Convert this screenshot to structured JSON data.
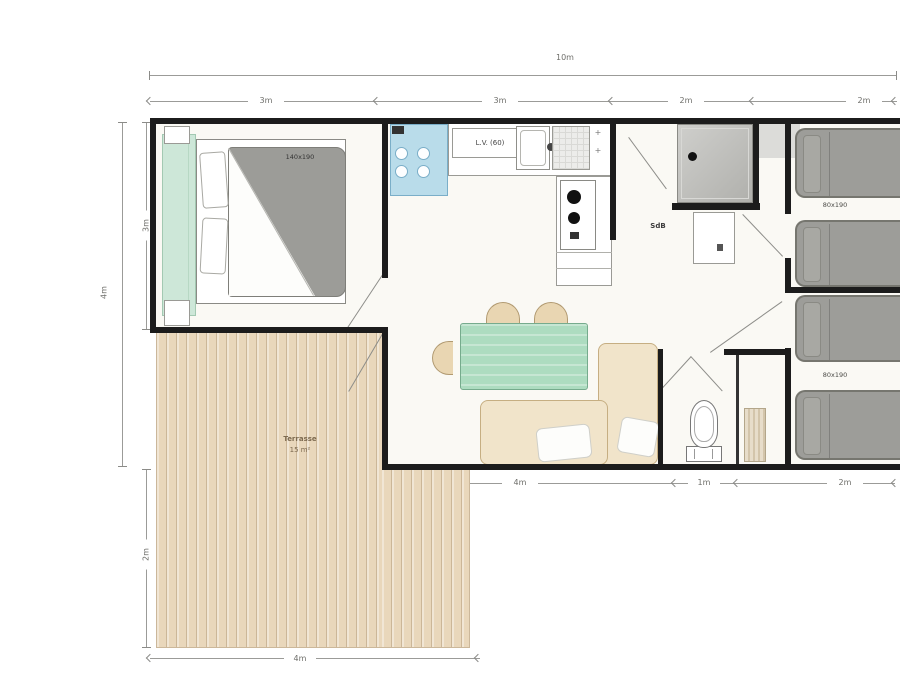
{
  "dimensions": {
    "top_total": "10m",
    "top_segments": [
      "3m",
      "3m",
      "2m",
      "2m"
    ],
    "left_outer": "4m",
    "left_inner": "3m",
    "left_terrace": "2m",
    "bottom_segments": [
      "4m",
      "1m",
      "2m"
    ],
    "bottom_terrace": "4m"
  },
  "labels": {
    "master_bed_size": "140x190",
    "kitchen_unit": "L.V. (60)",
    "bathroom": "SdB",
    "twin_beds_top": "80x190",
    "twin_beds_bottom": "80x190",
    "terrace_name": "Terrasse",
    "terrace_area": "15 m²",
    "plus_mark_1": "+",
    "plus_mark_2": "+"
  },
  "colors": {
    "wall": "#1c1c1c",
    "terrace_wood": "#e9d7bb",
    "wardrobe_mint": "#cde7d8",
    "table_green": "#addcc0",
    "bed_gray": "#9d9d99",
    "hob_blue": "#b9dcea",
    "sofa_beige": "#f1e4ca",
    "shower_gray": "#c0c0bd"
  }
}
